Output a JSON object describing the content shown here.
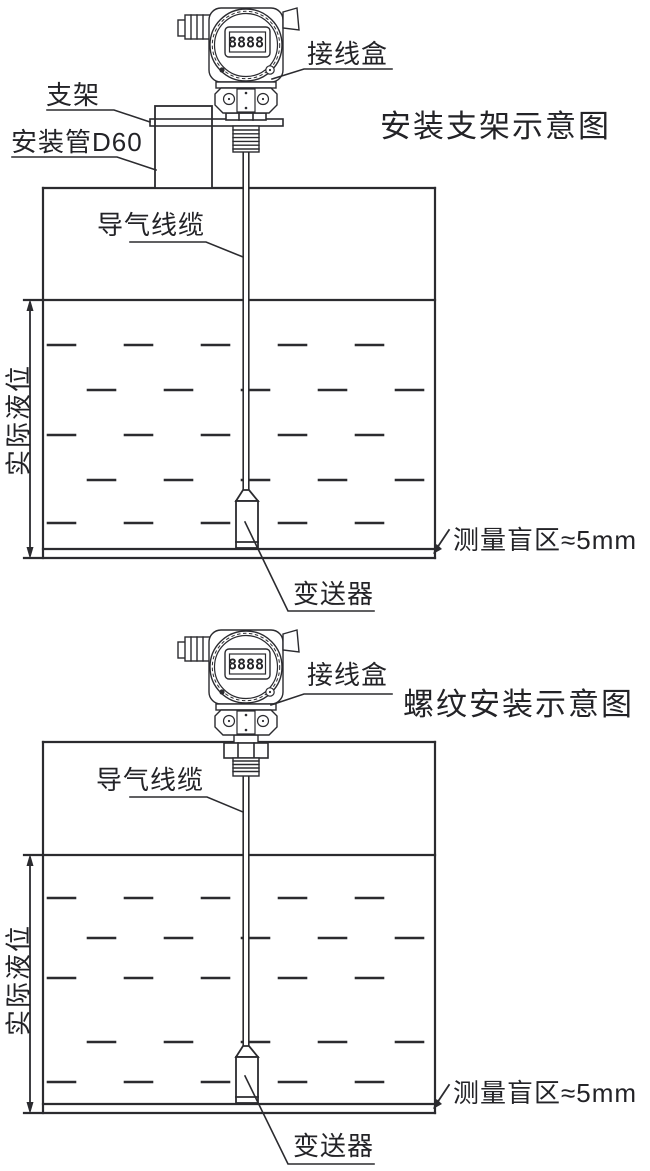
{
  "colors": {
    "ink": "#2b2b2f",
    "background": "#ffffff"
  },
  "diagram_top": {
    "title": "安装支架示意图",
    "display": "8888",
    "labels": {
      "bracket": "支架",
      "mounting_pipe": "安装管D60",
      "junction_box": "接线盒",
      "air_cable": "导气线缆",
      "actual_level": "实际液位",
      "transmitter": "变送器",
      "blind_zone": "测量盲区≈5mm"
    }
  },
  "diagram_bottom": {
    "title": "螺纹安装示意图",
    "display": "8888",
    "labels": {
      "junction_box": "接线盒",
      "air_cable": "导气线缆",
      "actual_level": "实际液位",
      "transmitter": "变送器",
      "blind_zone": "测量盲区≈5mm"
    }
  }
}
